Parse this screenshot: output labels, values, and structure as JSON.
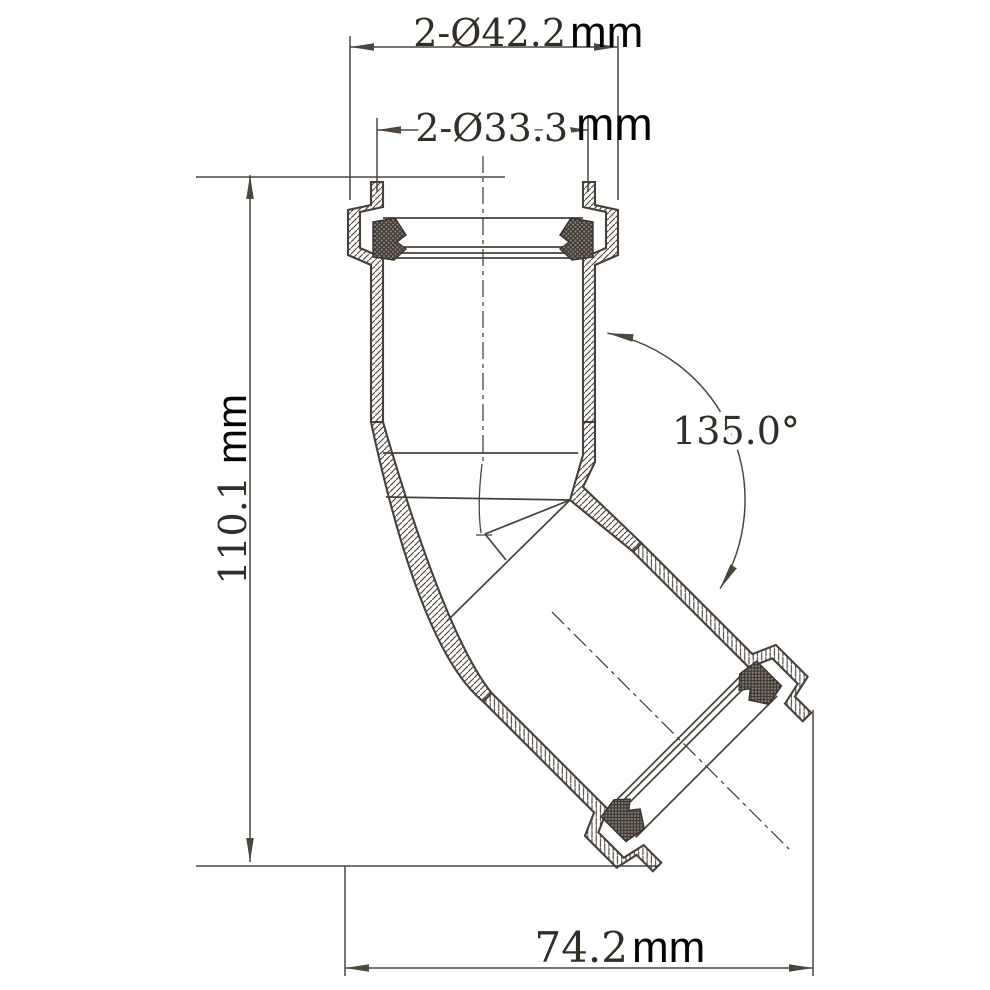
{
  "drawing": {
    "type": "technical-drawing",
    "subject": "135-degree elbow pipe fitting cross-section",
    "dimensions": {
      "socket_outer_diameter": {
        "value": "2-Ø42.2",
        "unit": "mm"
      },
      "socket_mouth_diameter": {
        "value": "2-Ø33.3",
        "unit": "mm"
      },
      "overall_height": {
        "value": "110.1",
        "unit": "mm"
      },
      "overall_width": {
        "value": "74.2",
        "unit": "mm"
      },
      "bend_angle": {
        "value": "135.0°"
      }
    },
    "colors": {
      "background": "#ffffff",
      "outline": "#46403a",
      "dimension_line": "#4c463f",
      "cad_text": "#322d27",
      "unit_text": "#050505",
      "hatch": "#564f48",
      "gasket_fill": "#857d74",
      "gasket_hatch": "#38332e"
    }
  }
}
